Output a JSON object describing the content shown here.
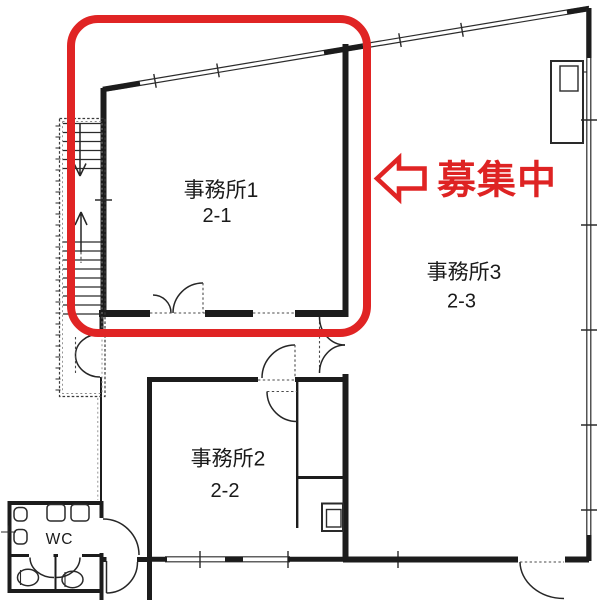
{
  "plan": {
    "type": "office-floor-plan",
    "floor_prefix": "2"
  },
  "colors": {
    "wall": "#1c1c1c",
    "highlight_red": "#e02424",
    "text": "#1a1a1a",
    "background": "#ffffff"
  },
  "highlight": {
    "label": "募集中",
    "highlighted_room": "事務所1",
    "arrow_icon": "left-arrow-outline-icon"
  },
  "rooms": [
    {
      "name": "事務所1",
      "unit": "2-1"
    },
    {
      "name": "事務所2",
      "unit": "2-2"
    },
    {
      "name": "事務所3",
      "unit": "2-3"
    }
  ],
  "wc": {
    "label": "WC"
  }
}
